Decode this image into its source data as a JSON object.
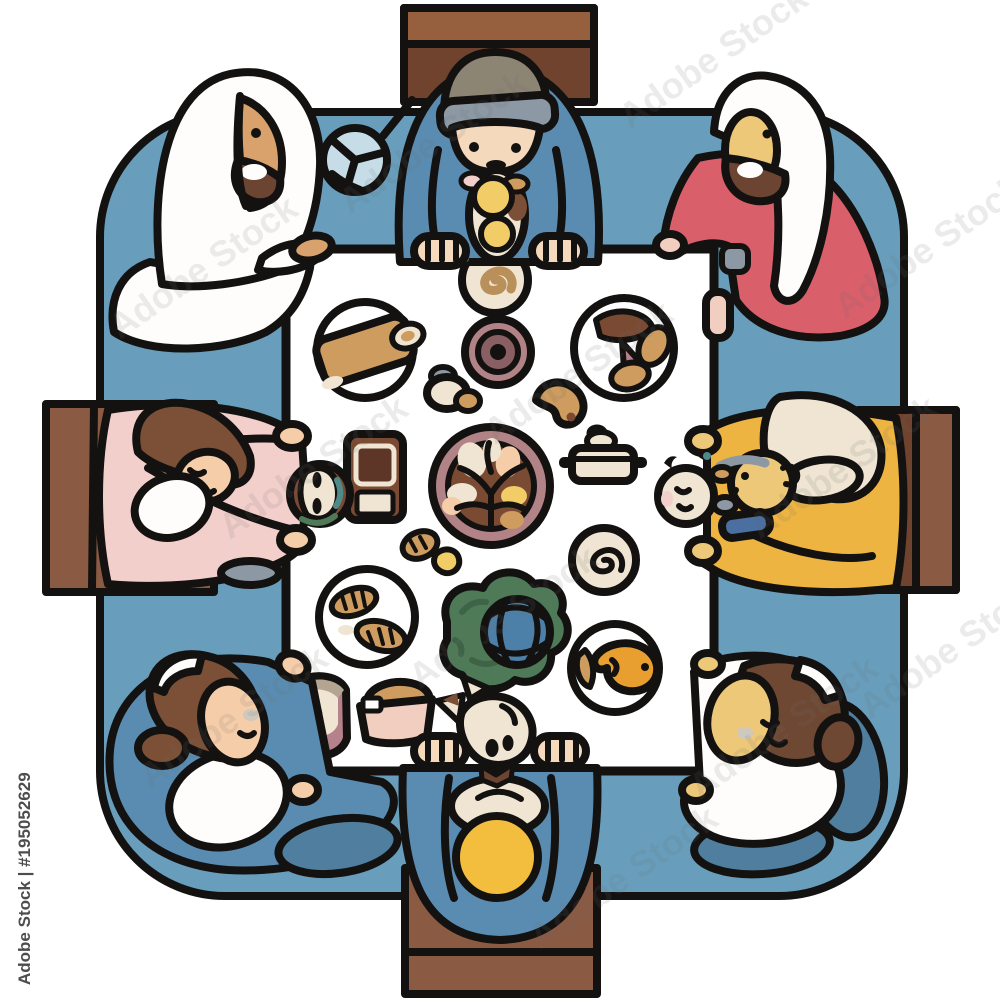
{
  "artwork": {
    "description": "Top-view flat cartoon illustration of a large family sharing a meal around a square white table set on a blue rounded rug, with brown chairs on four sides and many dishes of food on the tablecloth.",
    "style": "flat cartoon with thick black outlines"
  },
  "watermark": {
    "brand": "Adobe Stock",
    "id_label": "Adobe Stock | #195052629"
  },
  "colors": {
    "outline": "#131211",
    "rug": "#689EBC",
    "chair_light": "#96603F",
    "chair_mid": "#8A5A43",
    "chair_dark": "#6F432D",
    "table_white": "#FFFFFF",
    "cloth_white": "#FEFDFB",
    "shirt_blue": "#5A8CB2",
    "skirt_blue": "#4F7E9F",
    "cap_top": "#8D8574",
    "cap_band": "#8C98A4",
    "skin_light": "#F5D9BC",
    "skin_tan": "#D9A26C",
    "skin_gold": "#EDC878",
    "skin_peach": "#F5CDA9",
    "hand_pink": "#F2CEC0",
    "red_robe": "#D95F6B",
    "pink_dress": "#F3CFCB",
    "hair_brown": "#7C5036",
    "hair_dark": "#6E4833",
    "beard_dark": "#6B4532",
    "yellow_cloth": "#EDB441",
    "cream": "#EFE5D2",
    "head_yellow": "#F3BE3E",
    "food_tan": "#CE9C5E",
    "food_yellow": "#F2CC66",
    "mauve": "#B28386",
    "mauve_dark": "#8A5F63",
    "tray_brown": "#7A4A33",
    "tray_dark": "#5E3627",
    "teal": "#4E8A8A",
    "green": "#4E7A58",
    "leaf_dark": "#3E6347",
    "cabbage_blue": "#4C80A8",
    "fish_orange": "#E89F30",
    "meat_pink": "#B5818A",
    "gray_blue": "#8C98A4",
    "wrap_blue": "#4A6FA0",
    "fan_blue": "#C6DDE8",
    "mouth_gray": "#CFC8BD",
    "band_gray": "#B3A591",
    "swirl_tan": "#B9905A",
    "watermark_gray": "#6E6E6E",
    "watermark_id": "#4D4D4D"
  },
  "scene": {
    "rug": "blue rounded-square rug",
    "table": "white square tablecloth",
    "chairs": [
      "top",
      "left",
      "right",
      "bottom"
    ],
    "people": [
      {
        "position": "top-center",
        "appearance": "man in blue shirt and gray cap leaning over food"
      },
      {
        "position": "top-left",
        "appearance": "bearded man in white keffiyeh and robe"
      },
      {
        "position": "top-right",
        "appearance": "bearded man in white headscarf and red robe"
      },
      {
        "position": "middle-left",
        "appearance": "woman in pink dress holding a bowl"
      },
      {
        "position": "middle-right",
        "appearance": "white-haired elder in yellow holding a baby"
      },
      {
        "position": "bottom-left",
        "appearance": "woman in blue cardigan and white shirt"
      },
      {
        "position": "bottom-center",
        "appearance": "bald man in blue with a small pet in front"
      },
      {
        "position": "bottom-right",
        "appearance": "woman in white top and blue skirt"
      }
    ],
    "foods": [
      "spiral flatbread plate",
      "bread roll plate",
      "layered dip dish",
      "mushroom plate",
      "small mushrooms",
      "cashew pastry",
      "chocolate tray",
      "lidded pot",
      "centerpiece platter with branch pattern",
      "swirl dessert plate",
      "striped pastry",
      "croissant plate",
      "cabbage with blue lattice melon",
      "fish plate",
      "ham slice plate",
      "bread basket",
      "skewered snack stack",
      "hand fan"
    ]
  }
}
